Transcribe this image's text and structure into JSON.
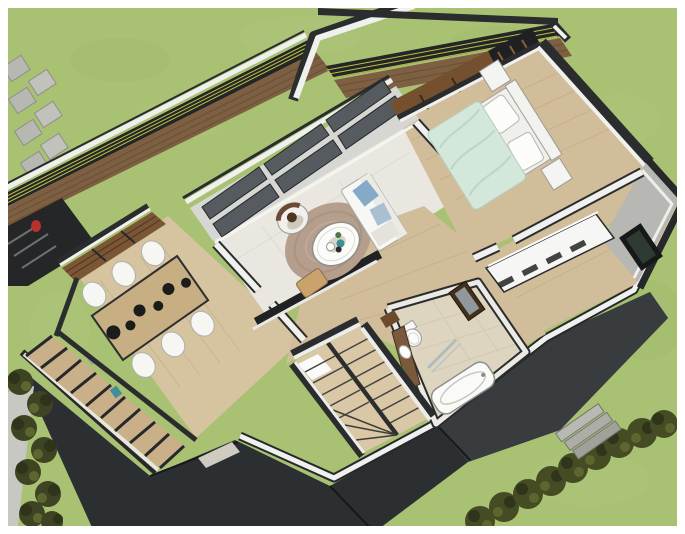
{
  "scene": {
    "title": "3D house model — upper floor cutaway, aerial view",
    "style": "architectural massing render (SketchUp-like)",
    "camera": "looking down into the cut-open second floor from above"
  },
  "palette": {
    "frame_white": "#ffffff",
    "grass": "#a9c173",
    "grass_light": "#b7cd88",
    "grass_dark": "#99b262",
    "roof_dark": "#2c2f31",
    "roof_facet": "#383c3e",
    "wall_dark": "#2a2c2d",
    "wall_white": "#f0f0ee",
    "wall_gray": "#b7b7b3",
    "floor_wood": "#d2bd9a",
    "floor_wood_dining": "#d6c3a0",
    "floor_tile": "#e9e7e0",
    "bath_tile": "#ddd5c0",
    "deck_wood": "#7d5f42",
    "shutter_wood": "#7b5635",
    "table_wood": "#c8ae83",
    "stairs_wood": "#d9c7a5",
    "duvet_mint": "#d3e7db",
    "sofa_white": "#f7f7f5",
    "pillow_blue": "#84aac8",
    "rug_taupe": "#b59e8c",
    "railing_dark": "#232526",
    "railing_cable": "#b9bf45",
    "stone_gray": "#b8b8b2",
    "hedge_olive": "#454c24",
    "bush_olive": "#3e4423",
    "path_gray": "#c8c8c2",
    "accent_red": "#bf2f28",
    "accent_teal": "#3e8f96",
    "fascia_beige": "#cfcbc0"
  },
  "landscape": {
    "lawn": "green lawn surrounding house",
    "paving_stones": {
      "count": 9,
      "layout": "two staggered columns, top-left garden"
    },
    "left_bushes": {
      "count": 8,
      "along": "left edge garden path"
    },
    "right_hedge": {
      "count": 9,
      "along": "diagonal row, bottom-right lawn"
    },
    "garden_path": "light gray path, bottom-left edge",
    "entry_steps": {
      "count": 3,
      "location": "right of lower roof"
    }
  },
  "building": {
    "roof": {
      "type": "dark hipped roof of lower level",
      "ridges": 3
    },
    "front_deck": {
      "railing_cables": 3,
      "surface": "wood planks",
      "item": "red pot"
    },
    "balcony": {
      "railing_cables": 3,
      "surface": "wood planks",
      "parapet": "white"
    },
    "rooms": [
      {
        "name": "Dining room",
        "floor": "wood",
        "furniture": [
          "long dining table",
          "6 white chairs",
          "6 dark bowls"
        ]
      },
      {
        "name": "Living room",
        "floor": "pale tile",
        "furniture": [
          "round taupe rug",
          "round white coffee table",
          "armchair with seated person",
          "white sofa with blue pillows",
          "tan side chair"
        ]
      },
      {
        "name": "Bedroom",
        "floor": "wood",
        "furniture": [
          "double bed",
          "mint duvet",
          "2 white pillows",
          "white headboard",
          "2 nightstands",
          "dark wardrobe"
        ]
      },
      {
        "name": "Walk-in closet",
        "floor": "wood",
        "furniture": [
          "white dresser with drawers"
        ]
      },
      {
        "name": "Bathroom",
        "floor": "beige tile",
        "furniture": [
          "toilet",
          "wood vanity with sink",
          "dark mirror cabinet",
          "bathtub",
          "glass shower screen",
          "green plant"
        ]
      },
      {
        "name": "Hallway",
        "floor": "wood"
      },
      {
        "name": "Staircase",
        "type": "switchback",
        "flights": 2,
        "winder_treads": 3,
        "skylight": "bright landing"
      }
    ],
    "glazing": {
      "living_room_panes": 6,
      "dining_window": "wood shutters",
      "bedroom_window": "wood shutters",
      "closet_wall_window": 1
    }
  }
}
